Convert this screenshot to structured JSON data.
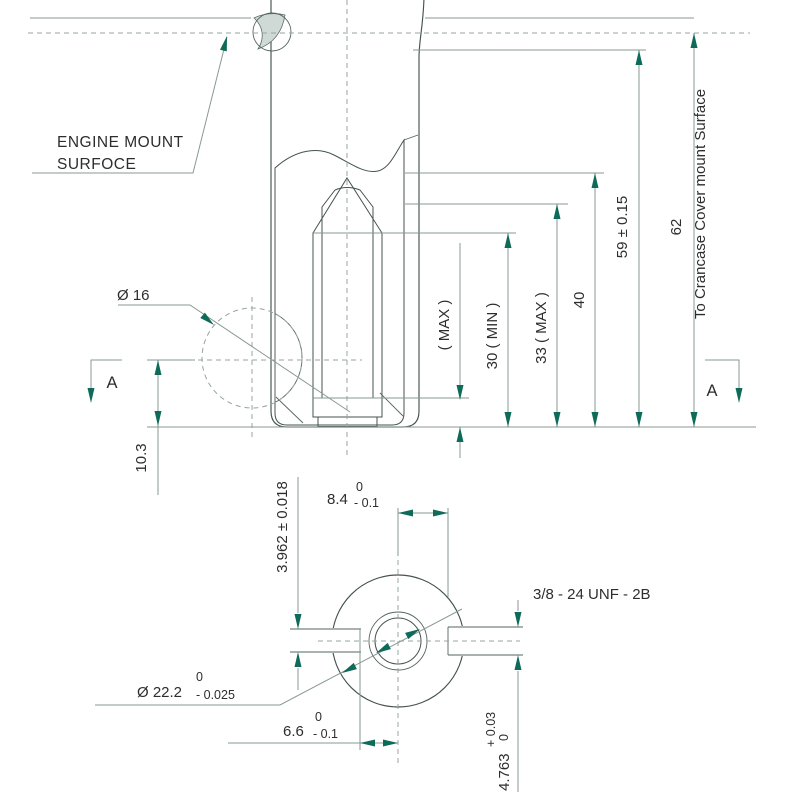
{
  "drawing": {
    "top_view": {
      "engine_mount_line1": "ENGINE MOUNT",
      "engine_mount_line2": "SURFOCE",
      "dia_16": "Ø 16",
      "dim_10_3": "10.3",
      "dim_max": "( MAX )",
      "dim_30_min": "30 ( MIN )",
      "dim_33_max": "33 ( MAX )",
      "dim_40": "40",
      "dim_59": "59 ± 0.15",
      "dim_62": "62",
      "crankcase_note": "To Crancase Cover mount Surface",
      "section_marker": "A"
    },
    "section_view": {
      "dim_8_4": "8.4",
      "tol_8_4_upper": "0",
      "tol_8_4_lower": "- 0.1",
      "dim_3_962": "3.962 ± 0.018",
      "thread_spec": "3/8 - 24 UNF - 2B",
      "dia_22_2": "Ø 22.2",
      "tol_22_2_upper": "0",
      "tol_22_2_lower": "- 0.025",
      "dim_6_6": "6.6",
      "tol_6_6_upper": "0",
      "tol_6_6_lower": "- 0.1",
      "dim_4_763": "4.763",
      "tol_4_763_upper": "+ 0.03",
      "tol_4_763_lower": "0"
    },
    "colors": {
      "body_fill": "#7FA6A1",
      "section_fill": "#CBD8D3",
      "hatch_line": "#67817C",
      "outline": "#44534E",
      "dim_line": "#8A9995",
      "arrow": "#0E6A59",
      "text": "#2D2D2D"
    }
  }
}
